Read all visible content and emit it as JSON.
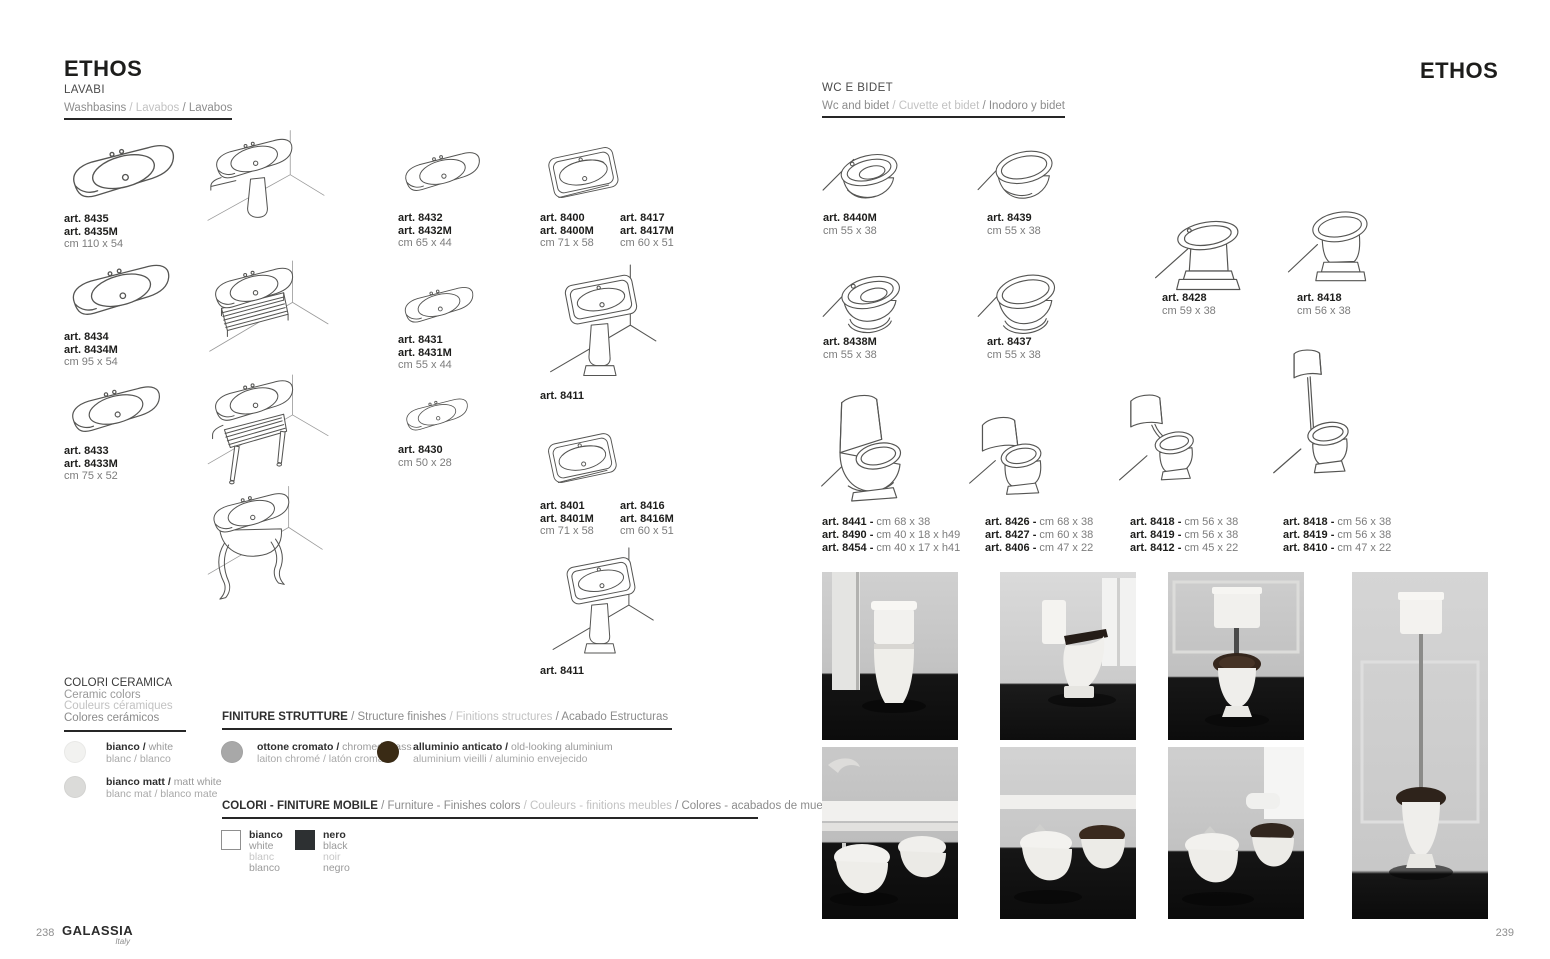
{
  "page_left": {
    "title": "ETHOS",
    "page_number": "238",
    "brand": "GALASSIA",
    "brand_sub": "Italy",
    "section": {
      "title": "LAVABI",
      "sub": [
        {
          "t": "Washbasins "
        },
        {
          "t": "/ Lavabos "
        },
        {
          "t": "/ Lavabos"
        }
      ]
    },
    "products": {
      "p8435": {
        "art1": "art. 8435",
        "art2": "art. 8435M",
        "dim": "cm 110 x 54"
      },
      "p8434": {
        "art1": "art. 8434",
        "art2": "art. 8434M",
        "dim": "cm 95 x 54"
      },
      "p8433": {
        "art1": "art. 8433",
        "art2": "art. 8433M",
        "dim": "cm 75 x 52"
      },
      "p8432": {
        "art1": "art. 8432",
        "art2": "art. 8432M",
        "dim": "cm 65 x 44"
      },
      "p8431": {
        "art1": "art. 8431",
        "art2": "art. 8431M",
        "dim": "cm 55 x 44"
      },
      "p8430": {
        "art1": "art. 8430",
        "dim": "cm 50 x 28"
      },
      "p8400": {
        "art1": "art. 8400",
        "art2": "art. 8400M",
        "dim": "cm 71 x 58"
      },
      "p8417": {
        "art1": "art. 8417",
        "art2": "art. 8417M",
        "dim": "cm 60 x 51"
      },
      "p8411a": {
        "art1": "art. 8411"
      },
      "p8401": {
        "art1": "art. 8401",
        "art2": "art. 8401M",
        "dim": "cm 71 x 58"
      },
      "p8416": {
        "art1": "art. 8416",
        "art2": "art. 8416M",
        "dim": "cm 60 x 51"
      },
      "p8411b": {
        "art1": "art. 8411"
      }
    },
    "ceramic_colors": {
      "title_it": "COLORI CERAMICA",
      "title_en": "Ceramic colors",
      "title_fr": "Couleurs céramiques",
      "title_es": "Colores cerámicos",
      "swatches": [
        {
          "name_b": "bianco / ",
          "name_r": "white",
          "line2": "blanc / blanco",
          "color": "#f2f2f0"
        },
        {
          "name_b": "bianco matt / ",
          "name_r": "matt white",
          "line2": "blanc mat / blanco mate",
          "color": "#dbdbd9"
        }
      ]
    },
    "structure_finishes": {
      "heading": [
        {
          "t": "FINITURE STRUTTURE "
        },
        {
          "t": "/ Structure finishes "
        },
        {
          "t": "/ Finitions structures "
        },
        {
          "t": "/ Acabado Estructuras"
        }
      ],
      "swatches": [
        {
          "name_b": "ottone cromato / ",
          "name_r": "chromed brass",
          "line2": "laiton chromé / latón cromado",
          "color": "#a8a8a8"
        },
        {
          "name_b": "alluminio anticato / ",
          "name_r": "old-looking aluminium",
          "line2": "aluminium vieilli / aluminio envejecido",
          "color": "#3a2b15"
        }
      ]
    },
    "furniture_finishes": {
      "heading": [
        {
          "t": "COLORI - FINITURE MOBILE "
        },
        {
          "t": "/ Furniture - Finishes colors "
        },
        {
          "t": "/ Couleurs - finitions meubles "
        },
        {
          "t": "/ Colores - acabados de muebles"
        }
      ],
      "swatches": [
        {
          "lines": [
            "bianco",
            "white",
            "blanc",
            "blanco"
          ],
          "color": "#ffffff"
        },
        {
          "lines": [
            "nero",
            "black",
            "noir",
            "negro"
          ],
          "color": "#2d3032"
        }
      ]
    }
  },
  "page_right": {
    "title": "ETHOS",
    "page_number": "239",
    "section": {
      "title": "WC E BIDET",
      "sub": [
        {
          "t": "Wc and bidet "
        },
        {
          "t": "/ Cuvette et bidet "
        },
        {
          "t": "/ Inodoro y bidet"
        }
      ]
    },
    "products": {
      "p8440M": {
        "art1": "art. 8440M",
        "dim": "cm 55 x 38"
      },
      "p8439": {
        "art1": "art. 8439",
        "dim": "cm 55 x 38"
      },
      "p8438M": {
        "art1": "art. 8438M",
        "dim": "cm 55 x 38"
      },
      "p8437": {
        "art1": "art. 8437",
        "dim": "cm 55 x 38"
      },
      "p8428": {
        "art1": "art. 8428",
        "dim": "cm 59 x 38"
      },
      "p8418": {
        "art1": "art. 8418",
        "dim": "cm 56 x 38"
      }
    },
    "groups": [
      {
        "rows": [
          {
            "art": "art. 8441 - ",
            "dim": "cm 68 x 38"
          },
          {
            "art": "art. 8490 - ",
            "dim": "cm 40 x 18 x h49"
          },
          {
            "art": "art. 8454 - ",
            "dim": "cm 40 x 17 x h41"
          }
        ]
      },
      {
        "rows": [
          {
            "art": "art. 8426 - ",
            "dim": "cm 68 x 38"
          },
          {
            "art": "art. 8427 - ",
            "dim": "cm 60 x 38"
          },
          {
            "art": "art. 8406 - ",
            "dim": "cm 47 x 22"
          }
        ]
      },
      {
        "rows": [
          {
            "art": "art. 8418 - ",
            "dim": "cm 56 x 38"
          },
          {
            "art": "art. 8419 - ",
            "dim": "cm 56 x 38"
          },
          {
            "art": "art. 8412 - ",
            "dim": "cm 45 x 22"
          }
        ]
      },
      {
        "rows": [
          {
            "art": "art. 8418 - ",
            "dim": "cm 56 x 38"
          },
          {
            "art": "art. 8419 - ",
            "dim": "cm 56 x 38"
          },
          {
            "art": "art. 8410 - ",
            "dim": "cm 47 x 22"
          }
        ]
      }
    ]
  }
}
